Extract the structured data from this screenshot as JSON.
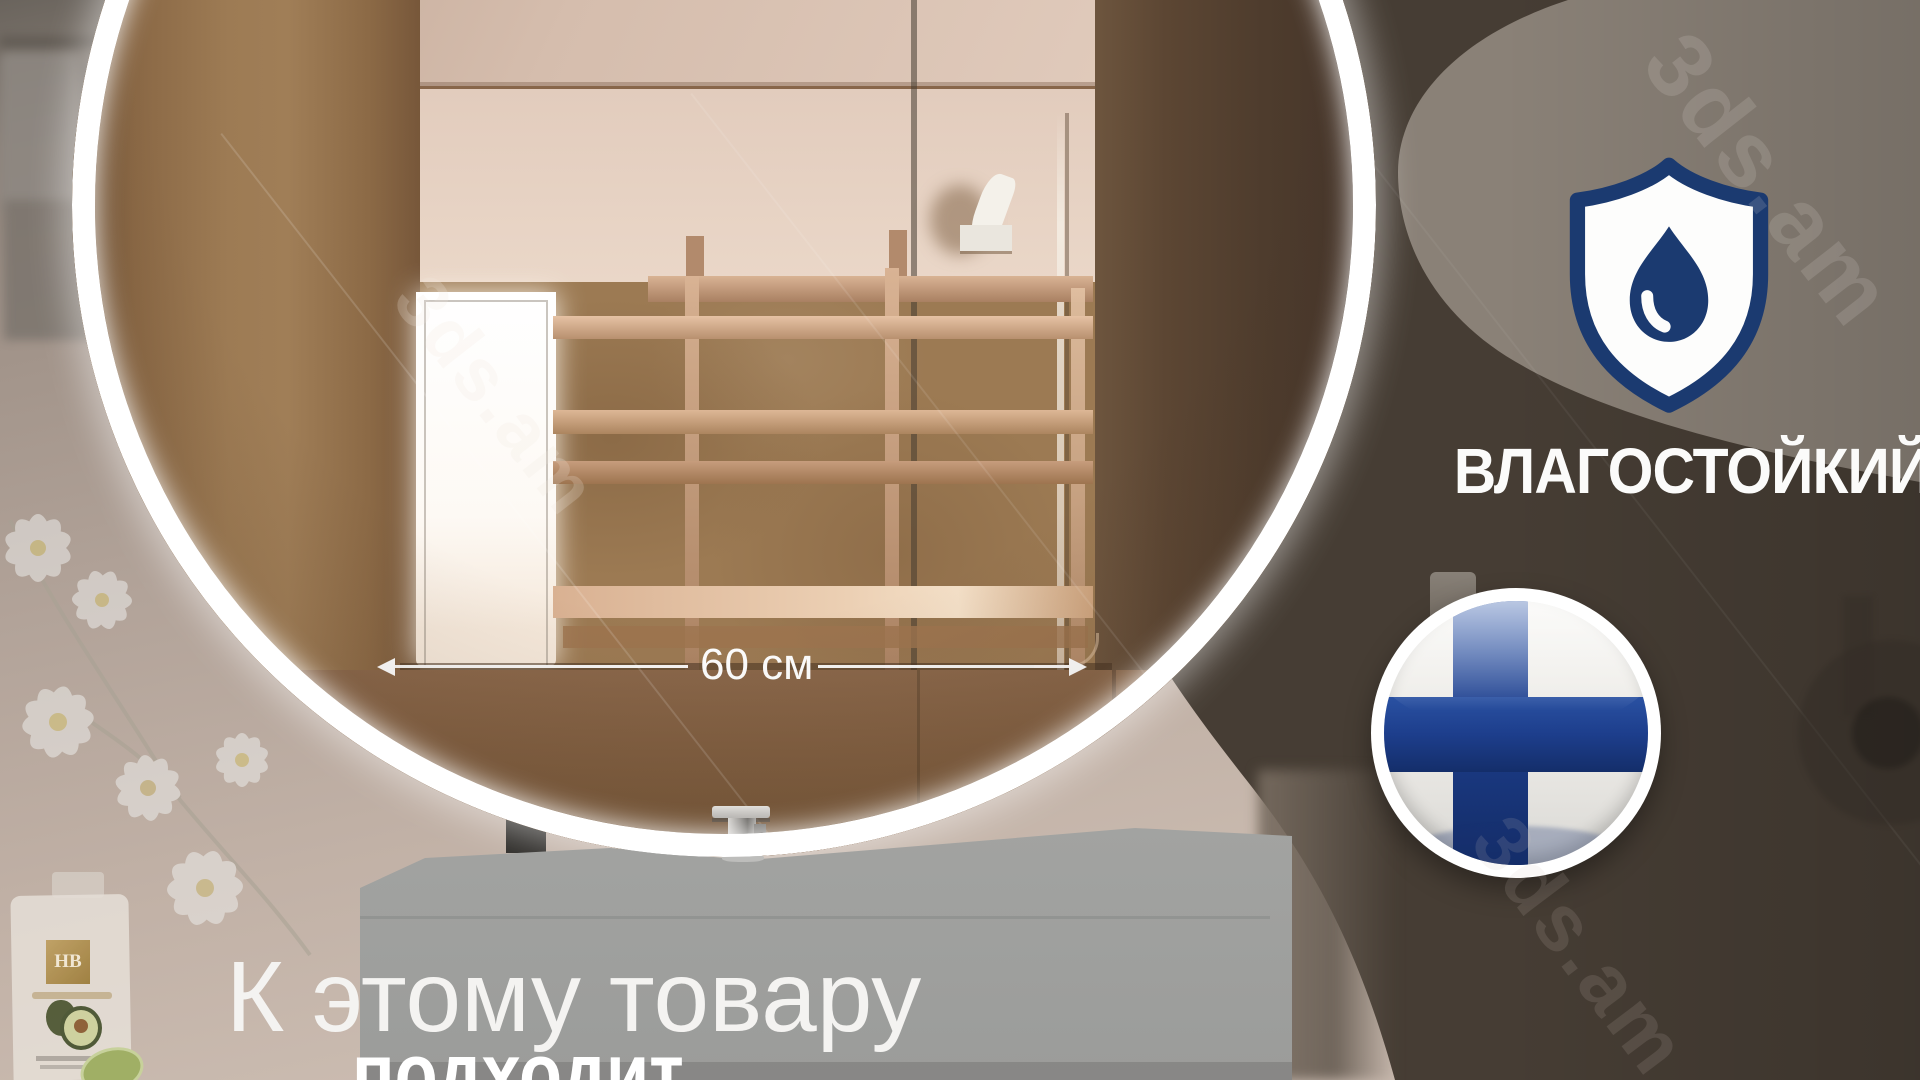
{
  "image": {
    "description": "Product banner of a round backlit bathroom mirror",
    "language": "ru"
  },
  "dimension": {
    "label": "60 см"
  },
  "features": {
    "moisture_resistant": {
      "label": "ВЛАГОСТОЙКИЙ",
      "icon": "shield-water-drop-icon"
    },
    "origin": {
      "country": "finland",
      "icon": "finland-flag-icon"
    }
  },
  "caption": {
    "line1": "К этому товару",
    "line2": "подходит"
  },
  "brand_bottle": {
    "label": "HB"
  },
  "watermark": {
    "text": "3ds.am"
  },
  "colors": {
    "accent_navy": "#1b3a70",
    "flag_navy": "#1d3e8c",
    "dark_panel": "#463d34",
    "gray_panel": "#8a8177",
    "ring_white": "#ffffff",
    "tile_brown": "#9c7a53",
    "vanity_gray": "#a9aaa8"
  }
}
